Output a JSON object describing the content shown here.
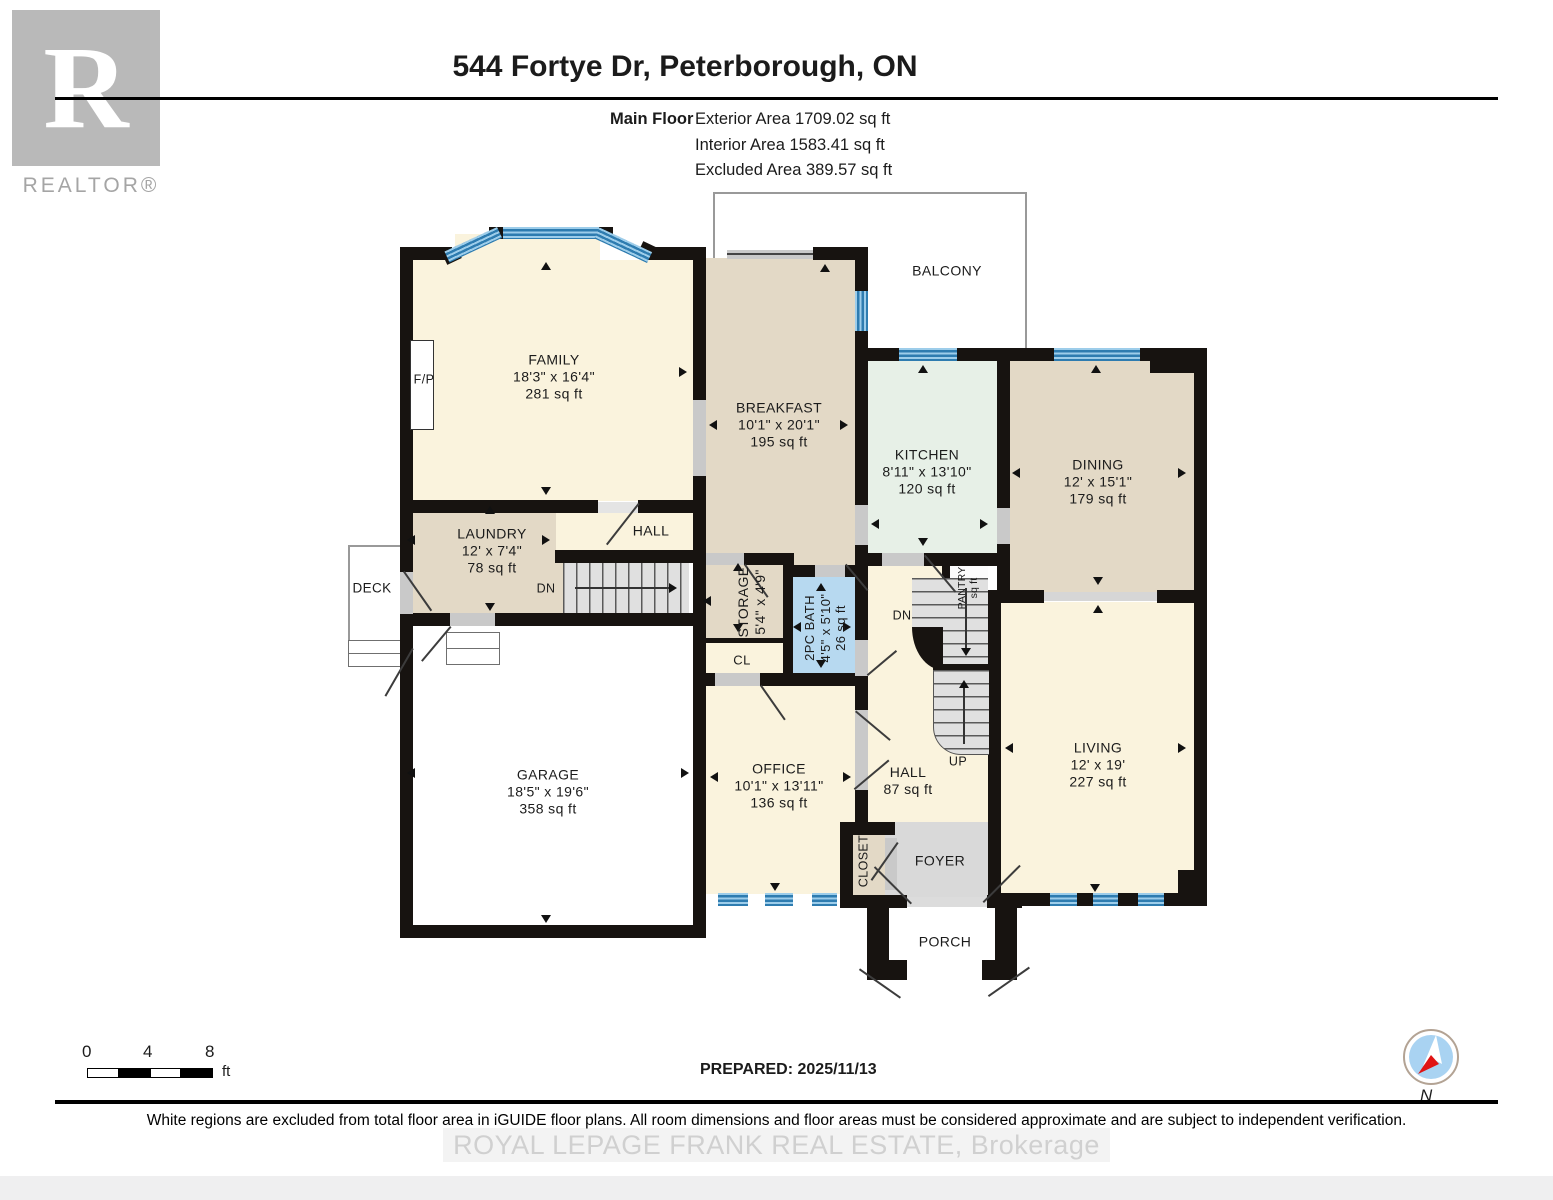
{
  "header": {
    "logo": {
      "letter": "R",
      "label": "REALTOR®"
    },
    "title": "544 Fortye Dr, Peterborough, ON",
    "floor_label": "Main Floor",
    "areas": [
      "Exterior Area 1709.02 sq ft",
      "Interior Area 1583.41 sq ft",
      "Excluded Area 389.57 sq ft"
    ]
  },
  "rooms": {
    "balcony": {
      "name": "BALCONY"
    },
    "family": {
      "name": "FAMILY",
      "dims": "18'3\" x 16'4\"",
      "area": "281 sq ft"
    },
    "breakfast": {
      "name": "BREAKFAST",
      "dims": "10'1\" x 20'1\"",
      "area": "195 sq ft"
    },
    "kitchen": {
      "name": "KITCHEN",
      "dims": "8'11\" x 13'10\"",
      "area": "120 sq ft"
    },
    "dining": {
      "name": "DINING",
      "dims": "12' x 15'1\"",
      "area": "179 sq ft"
    },
    "living": {
      "name": "LIVING",
      "dims": "12' x 19'",
      "area": "227 sq ft"
    },
    "laundry": {
      "name": "LAUNDRY",
      "dims": "12' x 7'4\"",
      "area": "78 sq ft"
    },
    "garage": {
      "name": "GARAGE",
      "dims": "18'5\" x 19'6\"",
      "area": "358 sq ft"
    },
    "office": {
      "name": "OFFICE",
      "dims": "10'1\" x 13'11\"",
      "area": "136 sq ft"
    },
    "hall_upper": {
      "name": "HALL"
    },
    "hall_lower": {
      "name": "HALL",
      "area": "87 sq ft"
    },
    "storage": {
      "name": "STORAGE",
      "dims": "5'4\" x 4'9\""
    },
    "bath": {
      "name": "2PC BATH",
      "dims": "4'5\" x 5'10\"",
      "area": "26 sq ft"
    },
    "cl": {
      "name": "CL"
    },
    "closet": {
      "name": "CLOSET"
    },
    "pantry": {
      "name": "PANTRY",
      "area": "sq ft"
    },
    "foyer": {
      "name": "FOYER"
    },
    "porch": {
      "name": "PORCH"
    },
    "deck": {
      "name": "DECK"
    },
    "fireplace": {
      "label": "F/P"
    },
    "stairs": {
      "up": "UP",
      "dn_left": "DN",
      "dn_right": "DN"
    }
  },
  "footer": {
    "scale": {
      "ticks": [
        "0",
        "4",
        "8"
      ],
      "unit": "ft"
    },
    "prepared": "PREPARED: 2025/11/13",
    "disclaimer": "White regions are excluded from total floor area in iGUIDE floor plans. All room dimensions and floor areas must be considered approximate and are subject to independent verification.",
    "watermark": "ROYAL LEPAGE FRANK REAL ESTATE, Brokerage",
    "compass_label": "N"
  },
  "colors": {
    "wall": "#171310",
    "window_blue": "#2e7cb0",
    "room_cream": "#faf3dd",
    "room_tan": "#e3d9c6",
    "room_mint": "#e7f0e7",
    "room_bath_blue": "#b7d9f0",
    "room_gray": "#d9d9d9",
    "logo_gray": "#b9b9b9"
  }
}
